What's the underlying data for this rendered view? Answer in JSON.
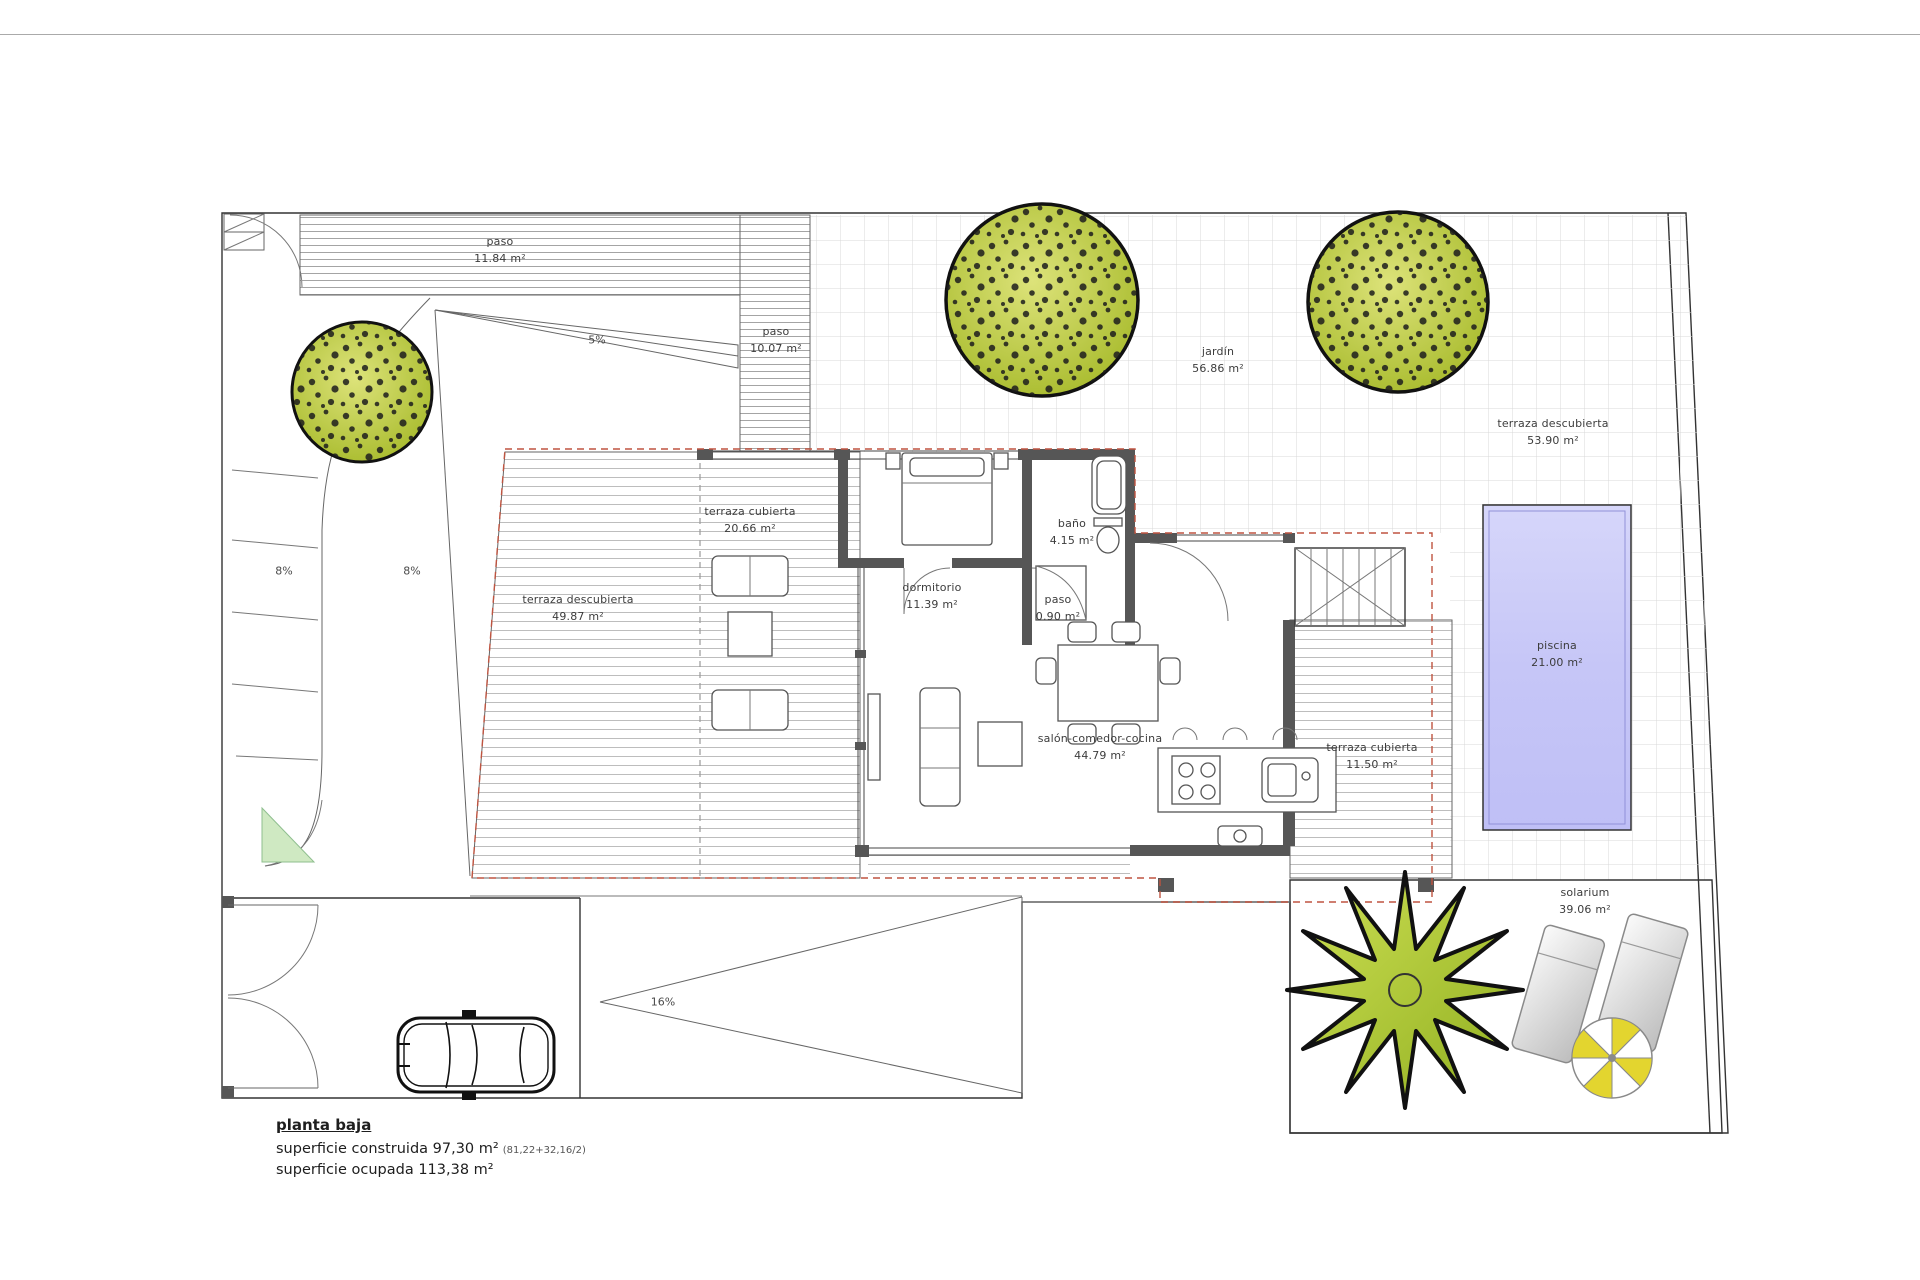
{
  "colors": {
    "wall": "#565656",
    "dash_red": "#bf5440",
    "pool_top": "#d6d6fa",
    "pool_bottom": "#bfbff6",
    "tree_light": "#dde37a",
    "tree_dark": "#a4b827",
    "grass": "#cfe9c2",
    "parasol_yellow": "#e3d52f"
  },
  "rooms": [
    {
      "name": "paso",
      "area": "11.84 m²"
    },
    {
      "name": "paso",
      "area": "10.07 m²"
    },
    {
      "name": "jardín",
      "area": "56.86 m²"
    },
    {
      "name": "terraza descubierta",
      "area": "53.90 m²"
    },
    {
      "name": "terraza cubierta",
      "area": "20.66 m²"
    },
    {
      "name": "dormitorio",
      "area": "11.39 m²"
    },
    {
      "name": "baño",
      "area": "4.15 m²"
    },
    {
      "name": "paso",
      "area": "0.90 m²"
    },
    {
      "name": "terraza descubierta",
      "area": "49.87 m²"
    },
    {
      "name": "salón-comedor-cocina",
      "area": "44.79 m²"
    },
    {
      "name": "terraza cubierta",
      "area": "11.50 m²"
    },
    {
      "name": "piscina",
      "area": "21.00 m²"
    },
    {
      "name": "solarium",
      "area": "39.06 m²"
    }
  ],
  "slopes": {
    "ramp_top": "5%",
    "ramp_left_a": "8%",
    "ramp_left_b": "8%",
    "ramp_garage": "16%"
  },
  "legend": {
    "title": "planta baja",
    "built_label": "superficie construida 97,30 m²",
    "built_note": "(81,22+32,16/2)",
    "occupied_label": "superficie ocupada 113,38 m²"
  }
}
